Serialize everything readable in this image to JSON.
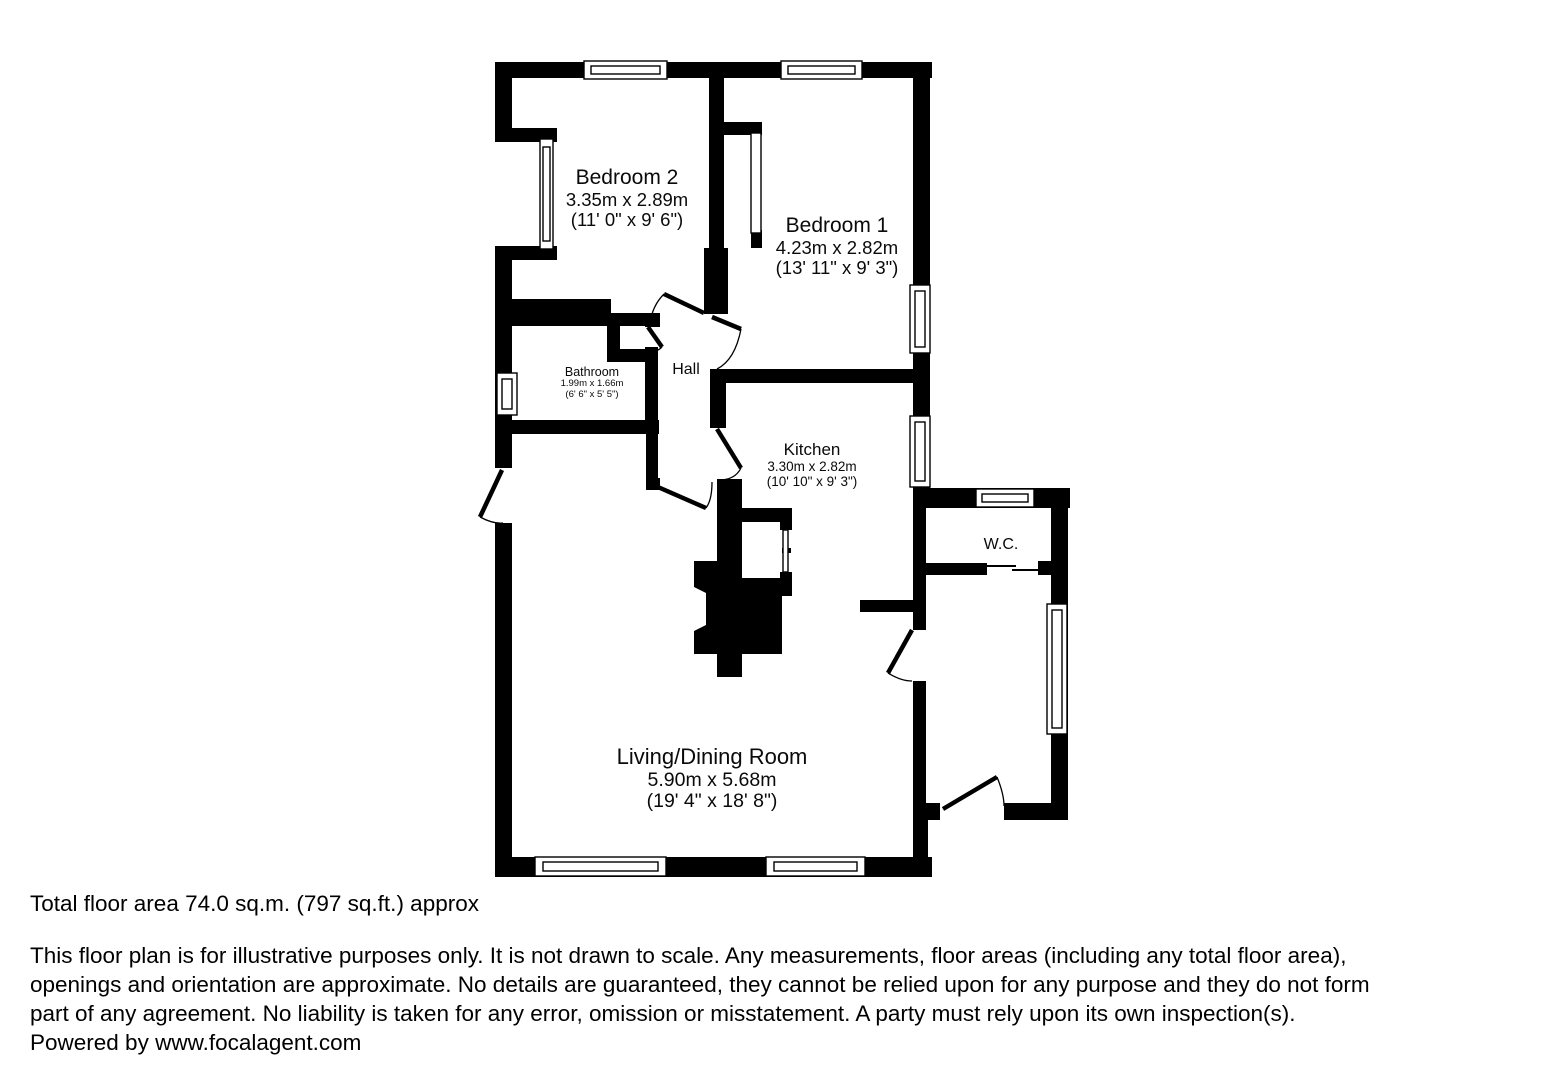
{
  "page": {
    "background_color": "#ffffff",
    "ink_color": "#000000"
  },
  "floorplan": {
    "rooms": [
      {
        "name": "Bedroom 2",
        "metric": "3.35m x 2.89m",
        "imperial": "(11' 0\" x 9' 6\")"
      },
      {
        "name": "Bedroom 1",
        "metric": "4.23m x 2.82m",
        "imperial": "(13' 11\" x 9' 3\")"
      },
      {
        "name": "Bathroom",
        "metric": "1.99m x 1.66m",
        "imperial": "(6' 6\" x 5' 5\")"
      },
      {
        "name": "Hall"
      },
      {
        "name": "Kitchen",
        "metric": "3.30m x 2.82m",
        "imperial": "(10' 10\" x 9' 3\")"
      },
      {
        "name": "W.C."
      },
      {
        "name": "Living/Dining Room",
        "metric": "5.90m x 5.68m",
        "imperial": "(19' 4\" x 18' 8\")"
      }
    ]
  },
  "footer": {
    "total_area": "Total floor area 74.0 sq.m. (797 sq.ft.) approx",
    "disclaimer_lines": [
      "This floor plan is for illustrative purposes only. It is not drawn to scale. Any measurements, floor areas (including any total floor area),",
      "openings and orientation are approximate. No details are guaranteed, they cannot be relied upon for any purpose and they do not form",
      "part of any agreement. No liability is taken for any error, omission or misstatement. A party must rely upon its own inspection(s).",
      "Powered by www.focalagent.com"
    ]
  }
}
